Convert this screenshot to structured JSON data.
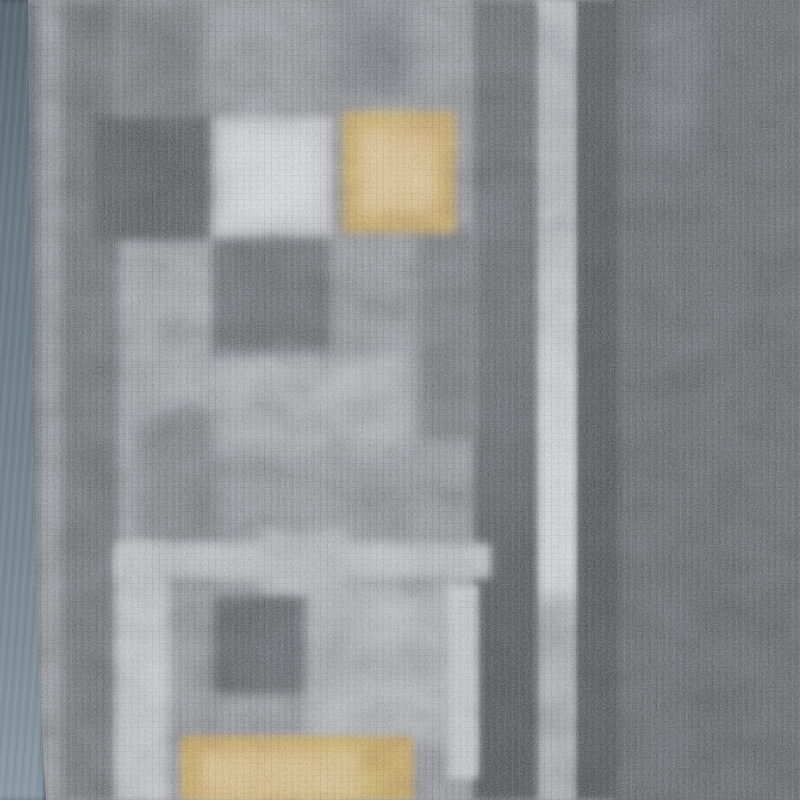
{
  "image": {
    "description": "Close-up photograph of a gray runner rug with a geometric pattern of charcoal, black, light-gray and amber-orange squares, thin light-gray line motifs, dark vertical border stripes on the right, and a smooth blue-gray bound rubber edge along the left side.",
    "width_px": 800,
    "height_px": 800
  },
  "scene": {
    "base_color": "#6e7176",
    "blocks": [
      {
        "name": "binding-seam-shadow",
        "x": 22,
        "y": 0,
        "w": 16,
        "h": 800,
        "color": "#3d444a",
        "blur": 5
      },
      {
        "name": "left-light-column",
        "x": 116,
        "y": 220,
        "w": 104,
        "h": 340,
        "color": "#7c8086",
        "blur": 10
      },
      {
        "name": "right-charcoal-field",
        "x": 614,
        "y": 0,
        "w": 186,
        "h": 800,
        "gradient": [
          [
            0,
            "#43464b"
          ],
          [
            100,
            "#3e4146"
          ]
        ]
      },
      {
        "name": "right-field-light-streak",
        "x": 646,
        "y": 0,
        "w": 58,
        "h": 150,
        "color": "#50545a",
        "blur": 12
      },
      {
        "name": "right-black-stripe",
        "x": 572,
        "y": 0,
        "w": 46,
        "h": 800,
        "blur": 3,
        "gradient": [
          [
            0,
            "#2f3236"
          ],
          [
            100,
            "#2b2e32"
          ]
        ]
      },
      {
        "name": "right-light-stripe",
        "x": 534,
        "y": 0,
        "w": 42,
        "h": 800,
        "blur": 3,
        "gradient": [
          [
            0,
            "#9ba1a8"
          ],
          [
            10,
            "#939aa1"
          ],
          [
            22,
            "#8f959c"
          ],
          [
            38,
            "#afb5bc"
          ],
          [
            52,
            "#c3c9cf"
          ],
          [
            66,
            "#cbd1d7"
          ],
          [
            73,
            "#c4cad0"
          ],
          [
            76,
            "#8a8e94"
          ],
          [
            100,
            "#83878d"
          ]
        ]
      },
      {
        "name": "center-dark-band",
        "x": 474,
        "y": 0,
        "w": 64,
        "h": 800,
        "blur": 4,
        "gradient": [
          [
            0,
            "#45484d"
          ],
          [
            40,
            "#45484d"
          ],
          [
            58,
            "#3c3f44"
          ],
          [
            72,
            "#2e3135"
          ],
          [
            100,
            "#2a2d31"
          ]
        ]
      },
      {
        "name": "mid-dark-column",
        "x": 418,
        "y": 226,
        "w": 60,
        "h": 212,
        "color": "#54575c",
        "blur": 7
      },
      {
        "name": "left-dark-stripe",
        "x": 62,
        "y": 0,
        "w": 56,
        "h": 800,
        "color": "#4b4e53",
        "blur": 5
      },
      {
        "name": "lower-left-dark-patch",
        "x": 138,
        "y": 415,
        "w": 84,
        "h": 145,
        "color": "#5a5d62",
        "blur": 10
      },
      {
        "name": "top-left-dark-patch",
        "x": 116,
        "y": 0,
        "w": 86,
        "h": 116,
        "color": "#53565b",
        "blur": 7
      },
      {
        "name": "top-center-dark-patch",
        "x": 332,
        "y": 0,
        "w": 76,
        "h": 94,
        "color": "#5b5f65",
        "blur": 9
      },
      {
        "name": "black-square-top",
        "x": 94,
        "y": 116,
        "w": 116,
        "h": 124,
        "color": "#35383c",
        "blur": 5
      },
      {
        "name": "white-square",
        "x": 216,
        "y": 118,
        "w": 116,
        "h": 116,
        "color": "#b9bcbe",
        "blur": 5
      },
      {
        "name": "white-square-highlight",
        "x": 230,
        "y": 132,
        "w": 88,
        "h": 88,
        "color": "#d0d2d4",
        "blur": 7
      },
      {
        "name": "orange-square",
        "x": 342,
        "y": 112,
        "w": 112,
        "h": 120,
        "color": "#b9873f",
        "blur": 5
      },
      {
        "name": "orange-square-highlight",
        "x": 358,
        "y": 128,
        "w": 80,
        "h": 88,
        "color": "#d8ab6a",
        "blur": 8
      },
      {
        "name": "dark-square-middle",
        "x": 212,
        "y": 240,
        "w": 118,
        "h": 120,
        "color": "#46494e",
        "blur": 5
      },
      {
        "name": "mid-light-band",
        "x": 216,
        "y": 354,
        "w": 194,
        "h": 98,
        "color": "#878c92",
        "blur": 9
      },
      {
        "name": "horizontal-light-line",
        "x": 118,
        "y": 544,
        "w": 372,
        "h": 34,
        "color": "#a4aab0",
        "blur": 5
      },
      {
        "name": "horizontal-light-patch",
        "x": 262,
        "y": 530,
        "w": 84,
        "h": 72,
        "color": "#9ba1a7",
        "blur": 7
      },
      {
        "name": "vertical-light-line-left",
        "x": 116,
        "y": 544,
        "w": 52,
        "h": 256,
        "color": "#abb1b7",
        "blur": 5
      },
      {
        "name": "dark-square-bottom",
        "x": 214,
        "y": 596,
        "w": 100,
        "h": 98,
        "color": "#3c3f44",
        "blur": 5
      },
      {
        "name": "bottom-light-square",
        "x": 306,
        "y": 586,
        "w": 148,
        "h": 158,
        "color": "#8d9297",
        "blur": 7
      },
      {
        "name": "bottom-vertical-light-stripe",
        "x": 448,
        "y": 586,
        "w": 30,
        "h": 192,
        "color": "#b2b8be",
        "blur": 4
      },
      {
        "name": "bottom-orange-rect",
        "x": 180,
        "y": 736,
        "w": 232,
        "h": 64,
        "color": "#b9873f",
        "blur": 4
      },
      {
        "name": "bottom-orange-highlight",
        "x": 200,
        "y": 750,
        "w": 160,
        "h": 50,
        "color": "#d4a765",
        "blur": 7
      }
    ],
    "front_blocks": [
      {
        "name": "rug-binding-edge",
        "x": 0,
        "y": 0,
        "w": 48,
        "h": 800,
        "gradient": [
          [
            0,
            "#5c6a73"
          ],
          [
            25,
            "#6b7a83"
          ],
          [
            55,
            "#75848d"
          ],
          [
            80,
            "#7f8e98"
          ],
          [
            100,
            "#8c9ba5"
          ]
        ],
        "clip": "polygon(0% 0%, 28px 0%, 30px 25%, 32px 50%, 35px 70%, 39px 85%, 46px 100%, 0% 100%)"
      }
    ]
  }
}
